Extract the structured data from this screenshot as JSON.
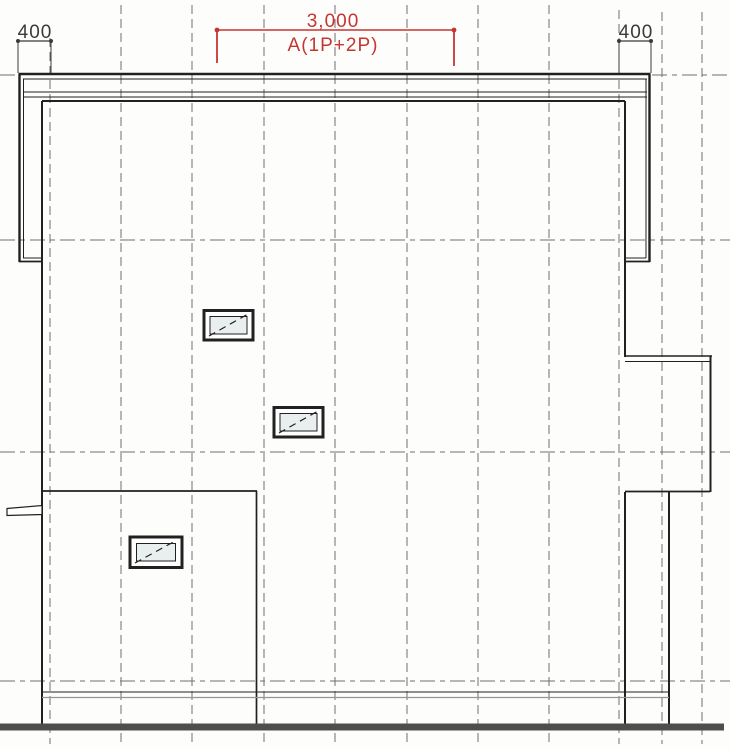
{
  "document": {
    "dimensions": {
      "top_left_value": "400",
      "top_center_value": "3,000",
      "top_center_label": "A(1P+2P)",
      "top_right_value": "400"
    },
    "colors": {
      "paper": "#fdfdfc",
      "line_dark": "#212121",
      "grid_gray": "#6f6f6f",
      "dimension_red": "#c63531",
      "dim_text": "#3a3a3a",
      "glass_tint": "#e9efef",
      "ground_gray": "#4e4e4e",
      "found_gray": "#949494"
    }
  }
}
